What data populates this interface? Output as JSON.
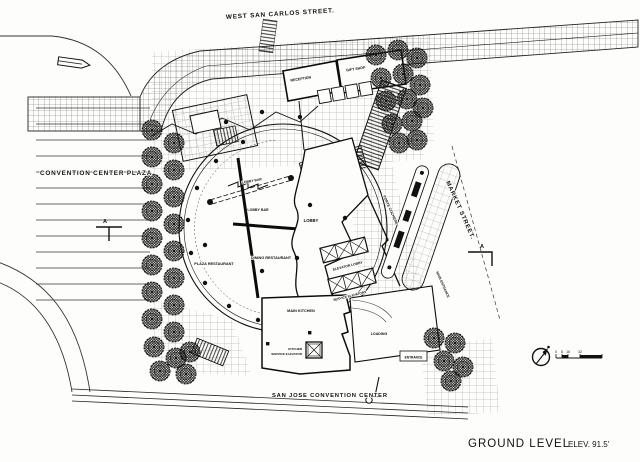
{
  "streets": {
    "top": "WEST SAN CARLOS STREET.",
    "plaza": "CONVENTION CENTER PLAZA",
    "right": "MARKET STREET.",
    "bottom": "SAN JOSE CONVENTION CENTER"
  },
  "title": {
    "main": "GROUND LEVEL",
    "elevation": "ELEV. 91.5'"
  },
  "rooms": {
    "reception": "RECEPTION",
    "gift_shop": "GIFT SHOP",
    "lobby": "LOBBY",
    "lobby_bar_upper": "LOBBY BAR",
    "lobby_bar_lower": "LOBBY BAR",
    "plaza_restaurant": "PLAZA RESTAURANT",
    "dining_restaurant": "DINING RESTAURANT",
    "elevator_lobby": "ELEVATOR LOBBY",
    "service_elevators": "SERVICE ELEVATORS",
    "porte_cochere": "PORTE COCHERE",
    "main_kitchen": "MAIN KITCHEN",
    "kitchen_service_line1": "KITCHEN",
    "kitchen_service_line2": "SERVICE ELEVATOR",
    "loading": "LOADING",
    "entrance": "ENTRANCE",
    "main_entrance": "MAIN ENTRANCE"
  },
  "markers": {
    "section_left": "A",
    "section_right": "A"
  },
  "scale": {
    "t0": "0",
    "t1": "8",
    "t2": "16",
    "t3": "32"
  },
  "colors": {
    "ink": "#111111",
    "paper": "#fdfdfb"
  }
}
